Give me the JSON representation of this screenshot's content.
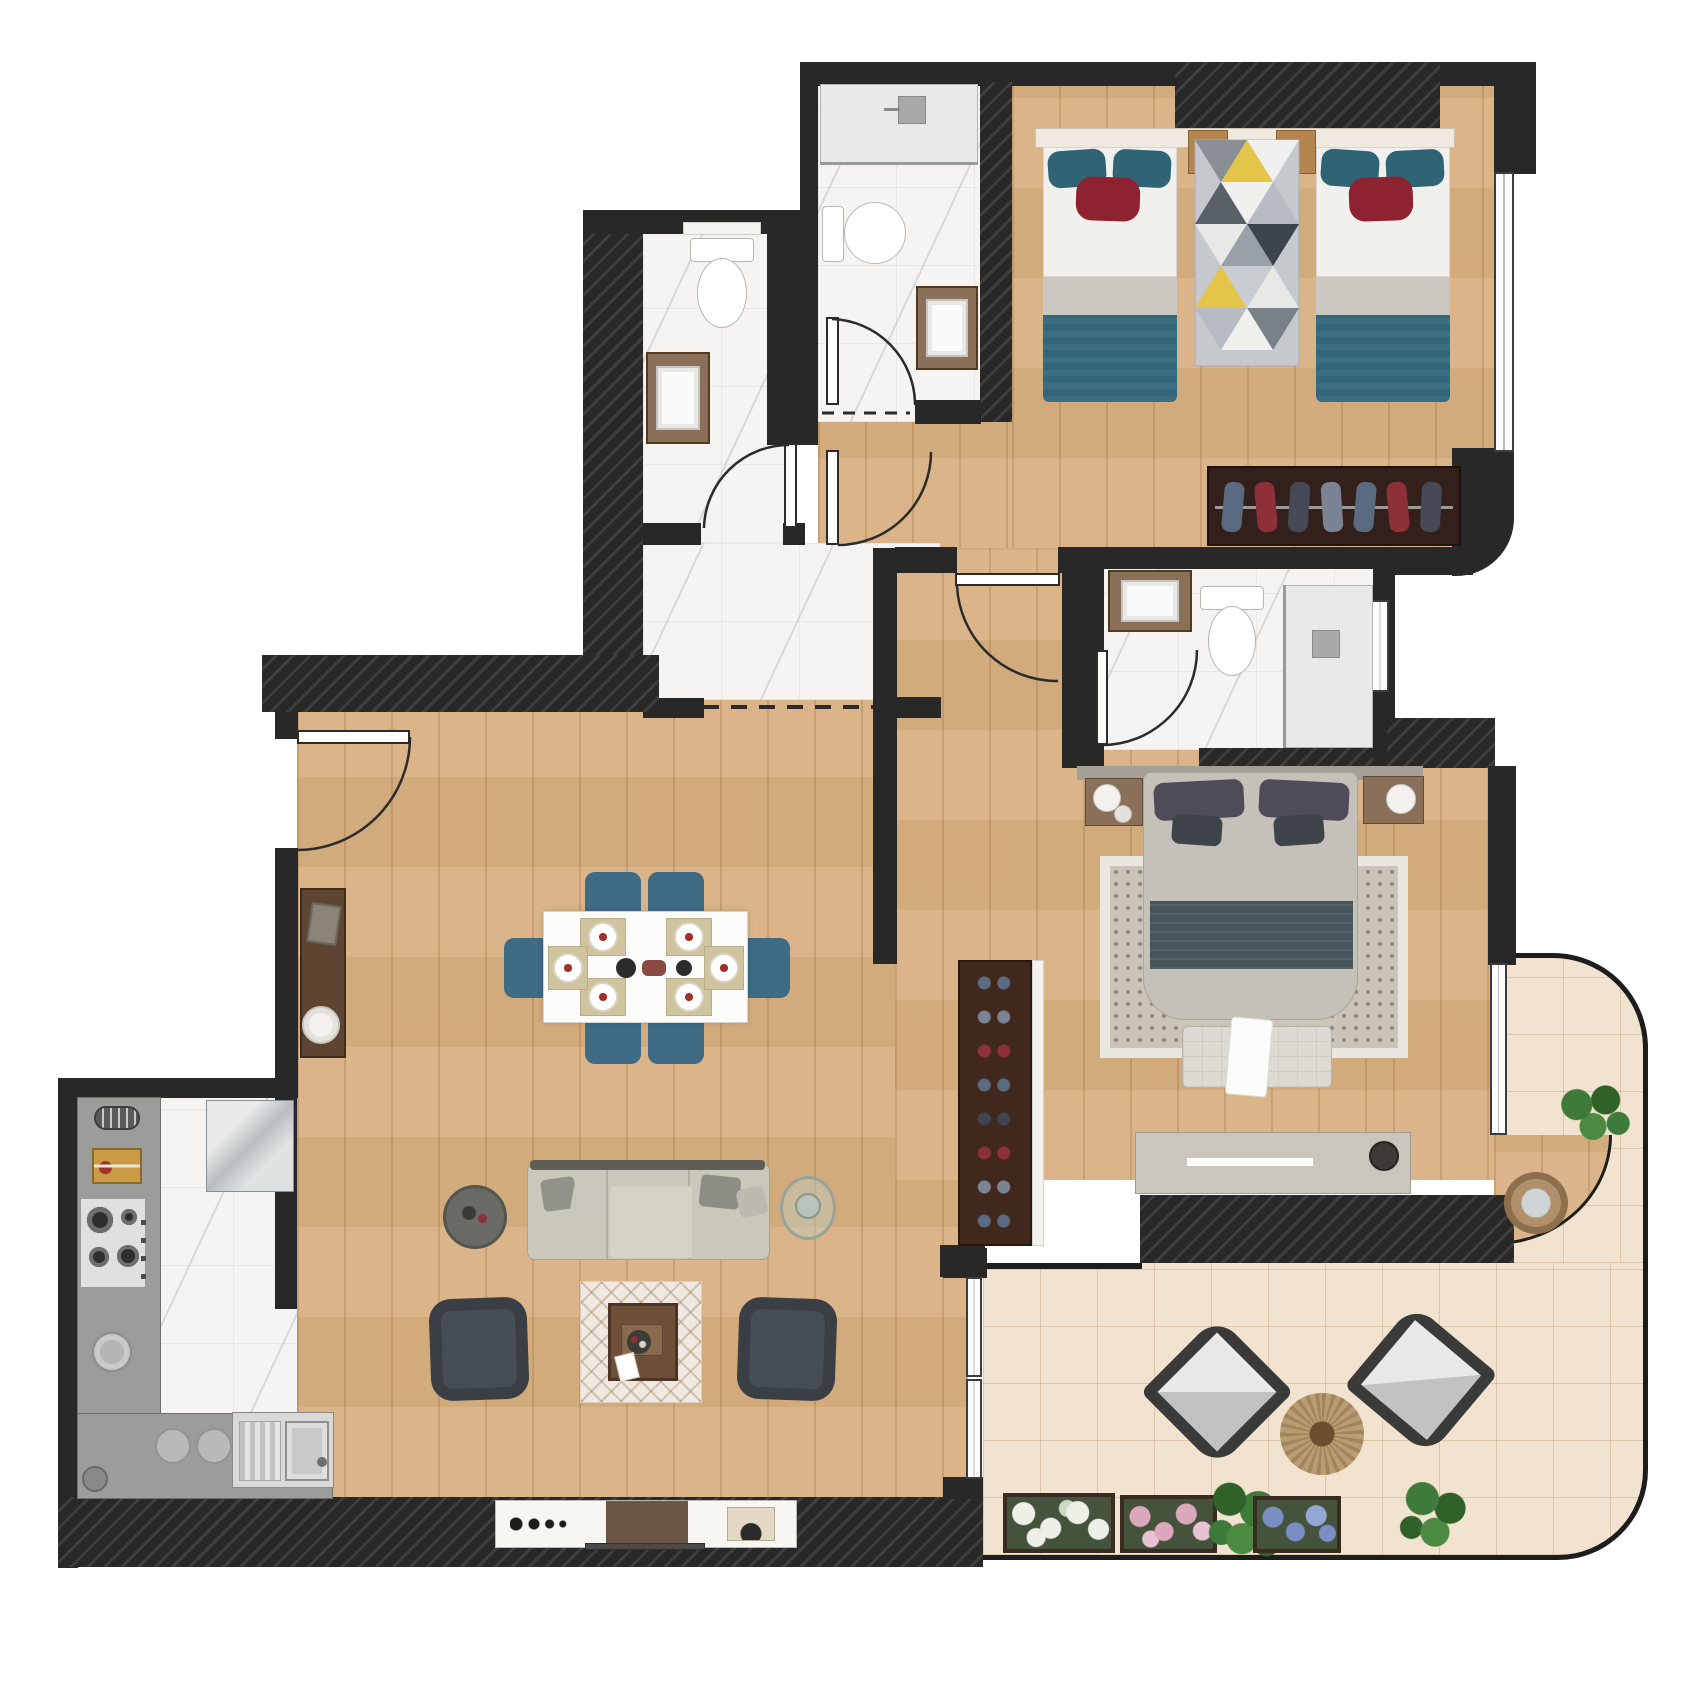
{
  "document": {
    "kind": "apartment floor plan, top-down 2D color rendering",
    "visible_text": "none",
    "units_shown": "none"
  },
  "palette": {
    "wood": "#d9b183",
    "marble": "#f5f4f2",
    "tile": "#f2e3d0",
    "wall": "#282828",
    "teal": "#2f6474",
    "redc": "#8e2230",
    "sheet": "#f1f0ed",
    "band": "#cbc8c2",
    "blanket": "#336678",
    "duvet": "#c5c1b8",
    "runner": "#46555c",
    "pdark": "#4f4b59",
    "mrug": "#cbc4b8",
    "rugborder": "#eae7e1",
    "bench": "#dcdad2",
    "dresser": "#cac6be",
    "headboard": "#a39f97",
    "nstand": "#8a7059",
    "cabinet": "#33201a",
    "scab": "#40281d",
    "cred": "#8e3038",
    "cblue": "#5a6a80",
    "cdark": "#454a56",
    "sofa": "#c9c8ba",
    "achair": "#474d55",
    "dchair": "#3e6c85",
    "table": "#fbfbf9",
    "mat": "#cfc49e",
    "ctable": "#6e4f38",
    "crug": "#efe9e1",
    "stable": "#6a6a64",
    "gtable": "#9aa39a",
    "console": "#5e4531",
    "counter": "#9c9c9a",
    "steel": "#ccd0d2",
    "board": "#c99b44",
    "jute": "#b99d72",
    "plant": "#3e7a3a",
    "fwhite": "#eef0e8",
    "fpink": "#dca8bc",
    "fblue": "#7a8fc4",
    "lframe": "#3a3a38",
    "lcush": "#d9d9d7",
    "leaf": "#fdfdfc",
    "winc": "#fdfdfd",
    "shower": "#e9e9e7"
  },
  "rooms": [
    {
      "name": "kids-bedroom",
      "floor": "wood",
      "furniture": [
        "twin-bed-left",
        "twin-bed-right",
        "triangle-pattern-rug",
        "headboard-shelf",
        "two-headboard-cubes",
        "wardrobe-with-hanging-clothes"
      ],
      "window": true,
      "rounded-corner": true
    },
    {
      "name": "family-bathroom",
      "floor": "marble",
      "fixtures": [
        "walk-in-shower-with-glass",
        "toilet",
        "wood-framed-vanity-sink",
        "swing-door"
      ]
    },
    {
      "name": "guest-bathroom",
      "floor": "marble",
      "fixtures": [
        "wall-shelf",
        "toilet",
        "wood-framed-vanity-sink",
        "swing-door"
      ]
    },
    {
      "name": "entrance-hall",
      "floor": "marble",
      "fixtures": [
        "dashed-threshold-to-living-room",
        "door-to-kids-bedroom"
      ]
    },
    {
      "name": "master-bedroom",
      "floor": "wood",
      "furniture": [
        "double-bed",
        "nightstand-left",
        "nightstand-right",
        "dotted-area-rug",
        "tufted-foot-bench-with-throw",
        "long-dresser",
        "shoe-cabinet"
      ],
      "window": true
    },
    {
      "name": "ensuite-bathroom",
      "floor": "marble",
      "fixtures": [
        "wood-framed-vanity-sink",
        "toilet",
        "walk-in-shower",
        "window",
        "swing-door"
      ]
    },
    {
      "name": "living-dining-room",
      "floor": "wood",
      "furniture": [
        "entry-console-with-phone",
        "round-floor-plate",
        "dining-table-six-settings",
        "six-blue-dining-chairs",
        "three-seat-sofa-with-pillows",
        "round-side-table",
        "round-glass-table",
        "two-dark-armchairs",
        "coffee-table-on-diamond-rug",
        "tv-console"
      ],
      "doors": [
        "main-entry-door"
      ]
    },
    {
      "name": "kitchen",
      "floor": "marble",
      "fixtures": [
        "l-shaped-gray-counter",
        "utensil-holder",
        "cutting-board",
        "four-burner-gas-hob",
        "prep-bowl",
        "stainless-refrigerator",
        "stainless-sink-with-drainboard",
        "two-round-plates",
        "small-bin"
      ]
    },
    {
      "name": "terrace",
      "floor": "stone-tile",
      "furniture": [
        "lounge-chair-left",
        "lounge-chair-right",
        "round-jute-rug",
        "flower-box-white",
        "flower-box-pink",
        "flower-box-blue",
        "green-plant-center",
        "green-plant-right",
        "potted-plant-upper",
        "round-planter-on-wood"
      ],
      "shape": "rounded outer corners with thin railing"
    }
  ],
  "counts": {
    "bedrooms": 2,
    "bathrooms": 3,
    "interior-doors": 6,
    "windows": 3,
    "sliding-door-panels": 2,
    "dining-seats": 6,
    "lounge-chairs": 2,
    "flower-boxes": 3
  }
}
